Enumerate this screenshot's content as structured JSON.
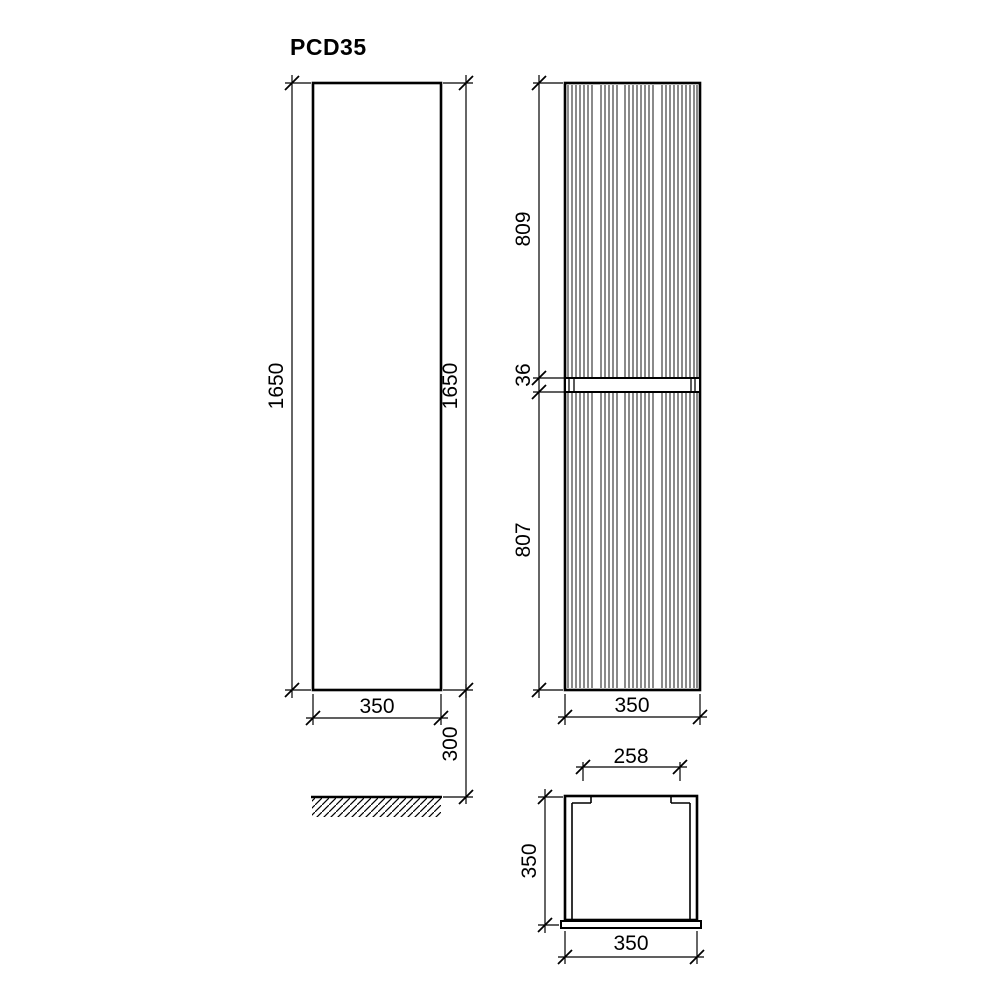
{
  "title": "PCD35",
  "colors": {
    "line": "#000000",
    "background": "#ffffff"
  },
  "views": {
    "side": {
      "height_left": "1650",
      "height_right": "1650",
      "width": "350",
      "floor_clearance": "300"
    },
    "front": {
      "upper_section": "809",
      "gap": "36",
      "lower_section": "807",
      "width": "350"
    },
    "top": {
      "opening_width": "258",
      "depth": "350",
      "width": "350"
    }
  }
}
